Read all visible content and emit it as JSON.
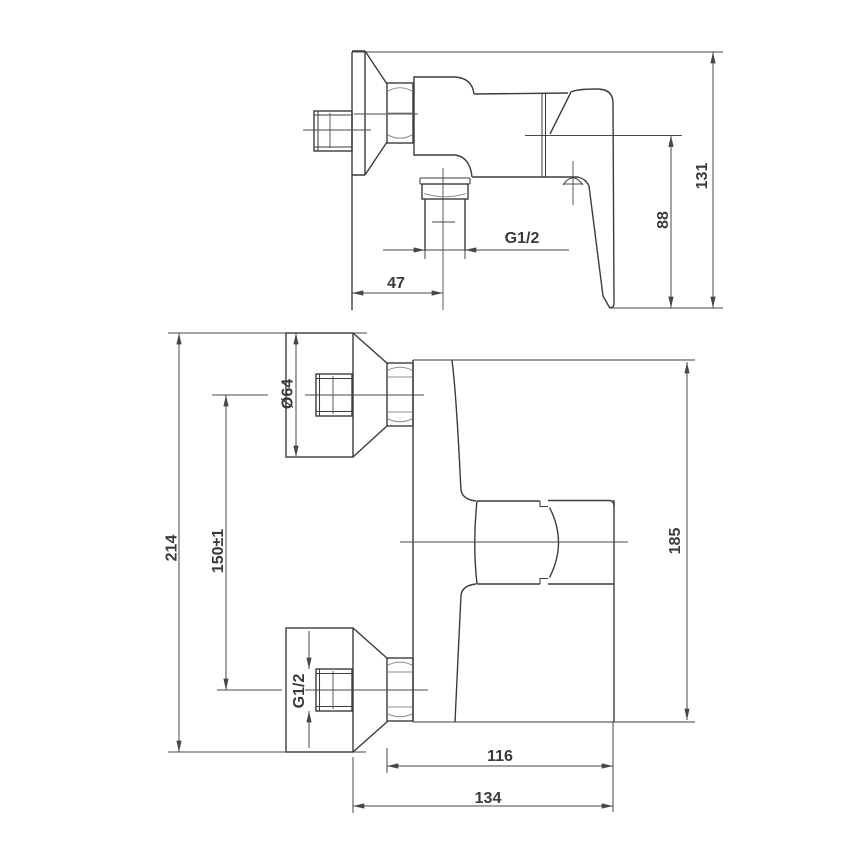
{
  "drawing": {
    "side_view": {
      "labels": {
        "overall_height": "131",
        "handle_drop": "88",
        "outlet_thread": "G1/2",
        "outlet_offset": "47"
      }
    },
    "front_view": {
      "labels": {
        "overall_height": "214",
        "inlet_spacing": "150±1",
        "flange_diameter": "Ø64",
        "inlet_thread": "G1/2",
        "body_height": "185",
        "projection_inner": "116",
        "projection_overall": "134"
      }
    },
    "colors": {
      "background": "#ffffff",
      "outline": "#3c3c3c",
      "dimension": "#474747",
      "accent_gray": "#8f8f8f"
    }
  }
}
